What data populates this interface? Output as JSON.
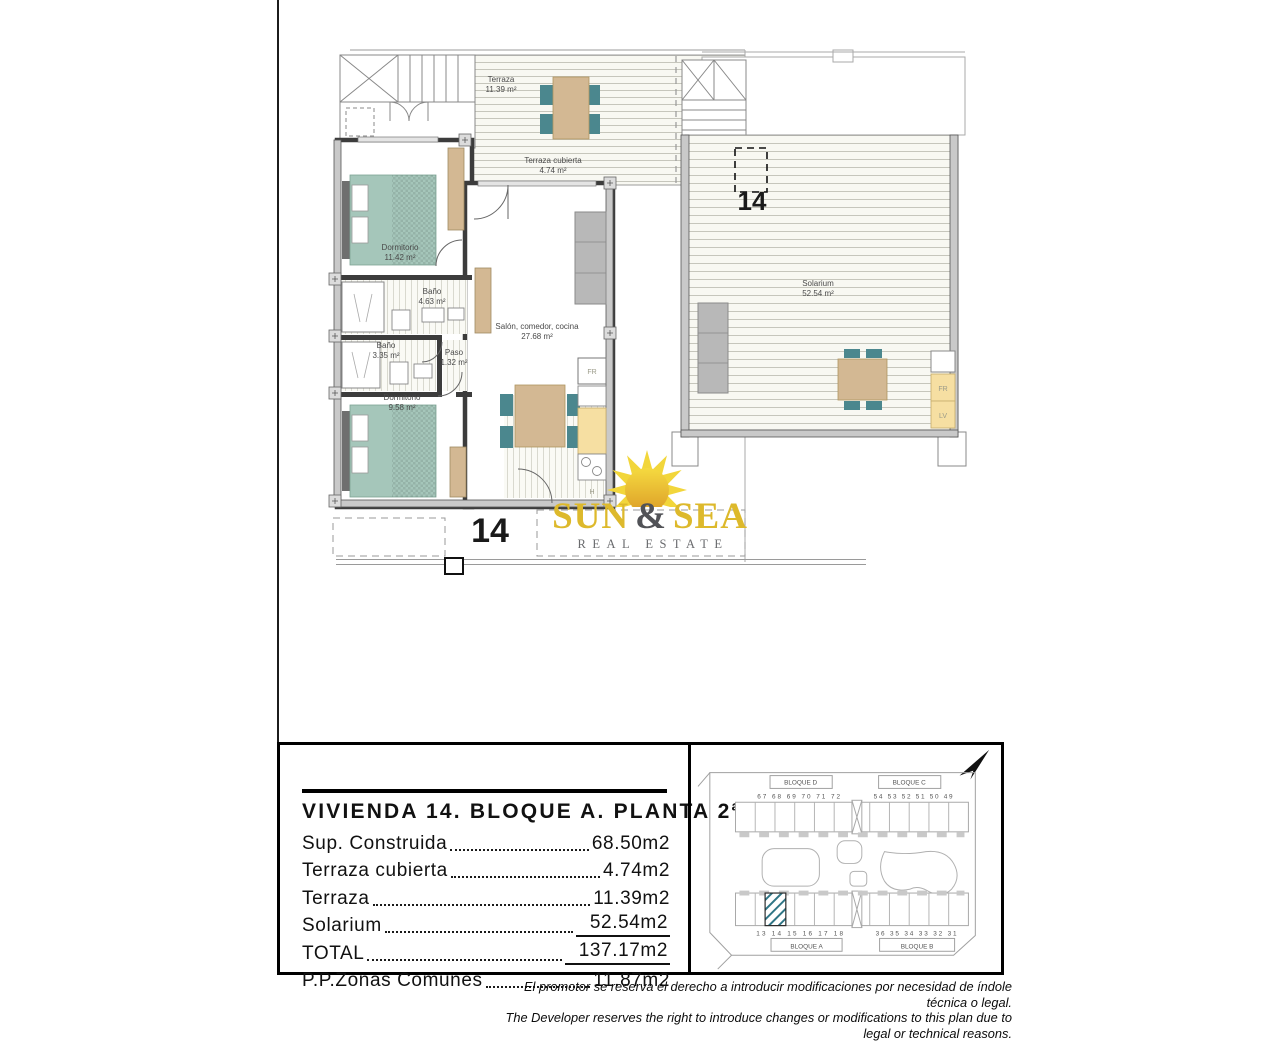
{
  "brand": {
    "sun": "SUN",
    "ampersand": "&",
    "sea": "SEA",
    "tagline": "REAL ESTATE",
    "colors": {
      "gold": "#ddb92c",
      "gray": "#515257",
      "sun_yellow": "#f2d63b",
      "sun_deep": "#dd9f28"
    }
  },
  "floor_plan_main": {
    "unit_number": "14",
    "rooms": {
      "terraza": {
        "name": "Terraza",
        "area": "11.39 m²"
      },
      "terraza_cubierta": {
        "name": "Terraza cubierta",
        "area": "4.74 m²"
      },
      "dormitorio_1": {
        "name": "Dormitorio",
        "area": "11.42 m²"
      },
      "bano_1": {
        "name": "Baño",
        "area": "4.63 m²"
      },
      "bano_2": {
        "name": "Baño",
        "area": "3.35 m²"
      },
      "paso": {
        "name": "Paso",
        "area": "1.32 m²"
      },
      "dormitorio_2": {
        "name": "Dormitorio",
        "area": "9.58 m²"
      },
      "salon": {
        "name": "Salón, comedor, cocina",
        "area": "27.68 m²"
      }
    },
    "appliances": {
      "fridge": "FR",
      "hob": "H"
    }
  },
  "floor_plan_solarium": {
    "unit_number": "14",
    "rooms": {
      "solarium": {
        "name": "Solarium",
        "area": "52.54 m²"
      }
    },
    "appliances": {
      "fridge": "FR",
      "dishwasher": "LV"
    }
  },
  "summary": {
    "title": "VIVIENDA 14. BLOQUE A. PLANTA 2ª",
    "rows": [
      {
        "label": "Sup. Construida",
        "value": "68.50m2"
      },
      {
        "label": "Terraza cubierta",
        "value": "4.74m2"
      },
      {
        "label": "Terraza",
        "value": "11.39m2"
      },
      {
        "label": "Solarium",
        "value": "52.54m2"
      },
      {
        "label": "TOTAL",
        "value": "137.17m2"
      },
      {
        "label": "P.P.Zonas Comunes",
        "value": "11.87m2"
      }
    ]
  },
  "site_plan": {
    "bloque_d": {
      "label": "BLOQUE D",
      "units": "67 68 69 70 71 72"
    },
    "bloque_c": {
      "label": "BLOQUE C",
      "units": "54 53 52 51 50 49"
    },
    "bloque_a": {
      "label": "BLOQUE A",
      "units": "13 14 15 16 17 18"
    },
    "bloque_b": {
      "label": "BLOQUE B",
      "units": "36 35 34 33 32 31"
    },
    "highlight_color": "#2f7585"
  },
  "disclaimer": {
    "line_es": "El promotor se reserva el derecho a introducir modificaciones por necesidad de índole técnica o legal.",
    "line_en": "The Developer reserves the right to introduce changes or modifications to this plan due to legal or technical reasons."
  }
}
